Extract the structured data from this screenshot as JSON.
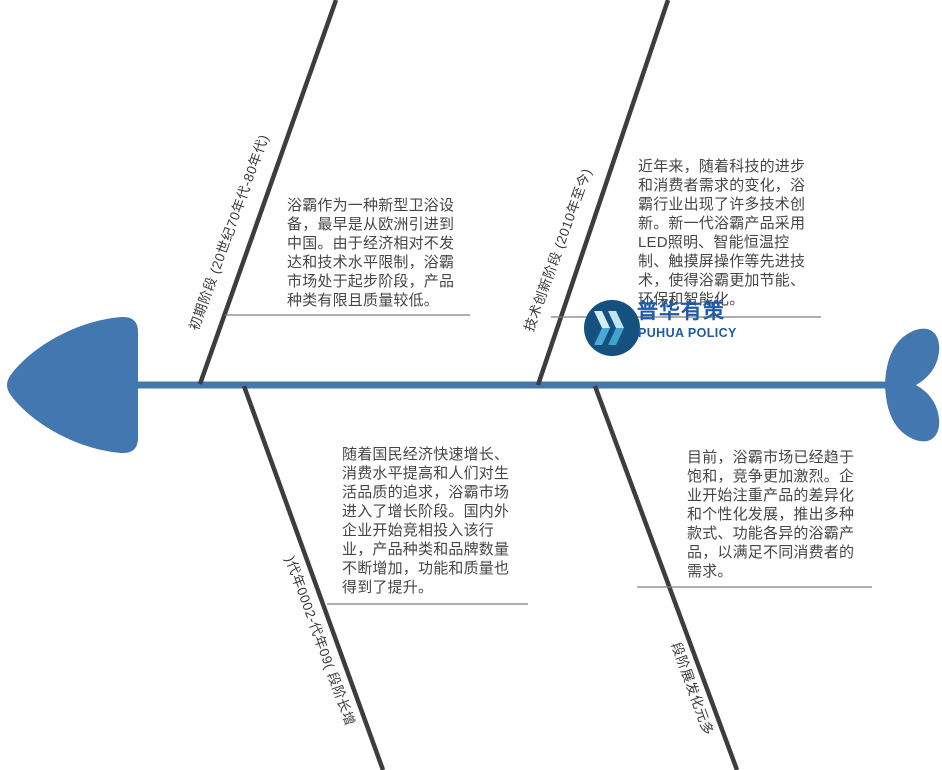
{
  "diagram": {
    "type": "fishbone",
    "colors": {
      "primary_blue": "#4377b0",
      "bone_gray": "#3d3d3d",
      "underline_gray": "#7f7f7f",
      "text_gray": "#464646"
    },
    "stages": [
      {
        "position": "top-left",
        "label": "初期阶段 (20世纪70年代-80年代)",
        "description": "浴霸作为一种新型卫浴设\n备，最早是从欧洲引进到\n中国。由于经济相对不发\n达和技术水平限制，浴霸\n市场处于起步阶段，产品\n种类有限且质量较低。"
      },
      {
        "position": "top-right",
        "label": "技术创新阶段 (2010年至今)",
        "description": "近年来，随着科技的进步\n和消费者需求的变化，浴\n霸行业出现了许多技术创\n新。新一代浴霸产品采用\nLED照明、智能恒温控\n制、触摸屏操作等先进技\n术，使得浴霸更加节能、\n环保和智能化。"
      },
      {
        "position": "bottom-left",
        "label": "增长阶段 (90年代-2000年代)",
        "description": "随着国民经济快速增长、\n消费水平提高和人们对生\n活品质的追求，浴霸市场\n进入了增长阶段。国内外\n企业开始竞相投入该行\n业，产品种类和品牌数量\n不断增加，功能和质量也\n得到了提升。"
      },
      {
        "position": "bottom-right",
        "label": "多元化发展阶段",
        "description": "目前，浴霸市场已经趋于\n饱和，竞争更加激烈。企\n业开始注重产品的差异化\n和个性化发展，推出多种\n款式、功能各异的浴霸产\n品，以满足不同消费者的\n需求。"
      }
    ]
  },
  "logo": {
    "name_zh": "普华有策",
    "name_en": "PUHUA POLICY",
    "text_color": "#1e5aa8",
    "circle_color": "#14517f"
  }
}
